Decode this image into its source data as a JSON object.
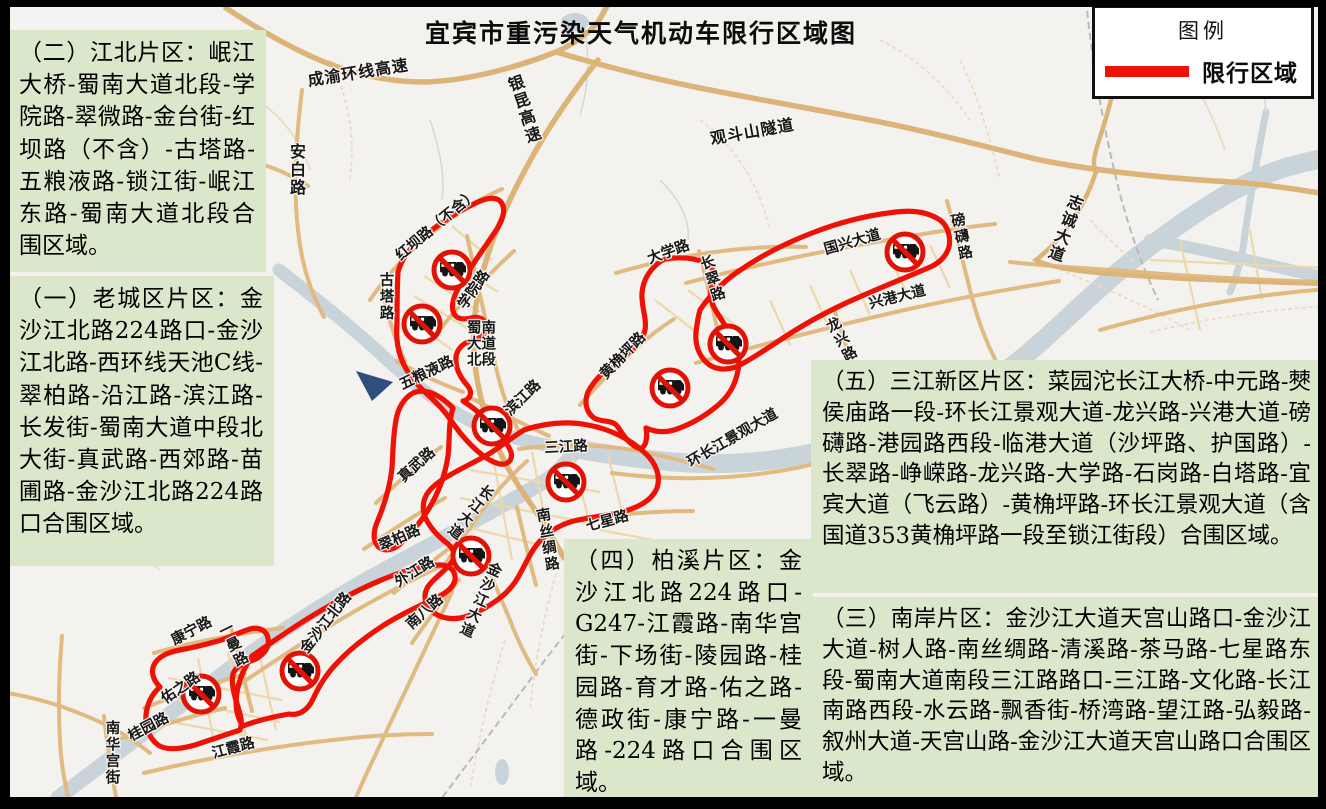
{
  "title": "宜宾市重污染天气机动车限行区域图",
  "legend": {
    "title": "图例",
    "restricted_label": "限行区域"
  },
  "zones": [
    {
      "id": "laochengqu",
      "heading": "（一）老城区片区：",
      "body": "金沙江北路224路口-金沙江北路-西环线天池C线-翠柏路-沿江路-滨江路-长发街-蜀南大道中段北大街-真武路-西郊路-苗圃路-金沙江北路224路口合围区域。"
    },
    {
      "id": "jiangbei",
      "heading": "（二）江北片区：",
      "body": "岷江大桥-蜀南大道北段-学院路-翠微路-金台街-红坝路（不含）-古塔路-五粮液路-锁江街-岷江东路-蜀南大道北段合围区域。"
    },
    {
      "id": "nanan",
      "heading": "（三）南岸片区：",
      "body": "金沙江大道天宫山路口-金沙江大道-树人路-南丝绸路-清溪路-茶马路-七星路东段-蜀南大道南段三江路路口-三江路-文化路-长江南路西段-水云路-飘香街-桥湾路-望江路-弘毅路-叙州大道-天宫山路-金沙江大道天宫山路口合围区域。"
    },
    {
      "id": "baixi",
      "heading": "（四）柏溪片区：",
      "body": "金沙江北路224路口-G247-江霞路-南华宫街-下场街-陵园路-桂园路-育才路-佑之路-德政街-康宁路-一曼路-224路口合围区域。"
    },
    {
      "id": "sanjiang",
      "heading": "（五）三江新区片区：",
      "body": "菜园沱长江大桥-中元路-僰侯庙路一段-环长江景观大道-龙兴路-兴港大道-磅礴路-港园路西段-临港大道（沙坪路、护国路）-长翠路-峥嵘路-龙兴路-大学路-石岗路-白塔路-宜宾大道（飞云路）-黄桷坪路-环长江景观大道（含国道353黄桷坪路一段至锁江街段）合围区域。"
    }
  ],
  "map": {
    "road_labels": [
      "成渝环线高速",
      "银昆高速",
      "观斗山隧道",
      "安白路",
      "志诚大道",
      "红坝路（不含）",
      "古塔路",
      "学院路",
      "蜀南大道北段",
      "五粮液路",
      "滨江路",
      "三江路",
      "黄桷坪路",
      "大学路",
      "长翠路",
      "国兴大道",
      "磅礴路",
      "兴港大道",
      "龙兴路",
      "环长江景观大道",
      "真武路",
      "翠柏路",
      "外江路",
      "南八路",
      "长江大道",
      "南丝绸路",
      "七星路",
      "金沙江大道",
      "金沙江北路",
      "康宁路",
      "一曼路",
      "佑之路",
      "桂园路",
      "南华宫街",
      "江霞路"
    ]
  },
  "colors": {
    "restricted_zone": "#ee1106",
    "info_box_bg": "#dbe7cb",
    "road": "#e0ba80",
    "river": "#c9d3da"
  }
}
